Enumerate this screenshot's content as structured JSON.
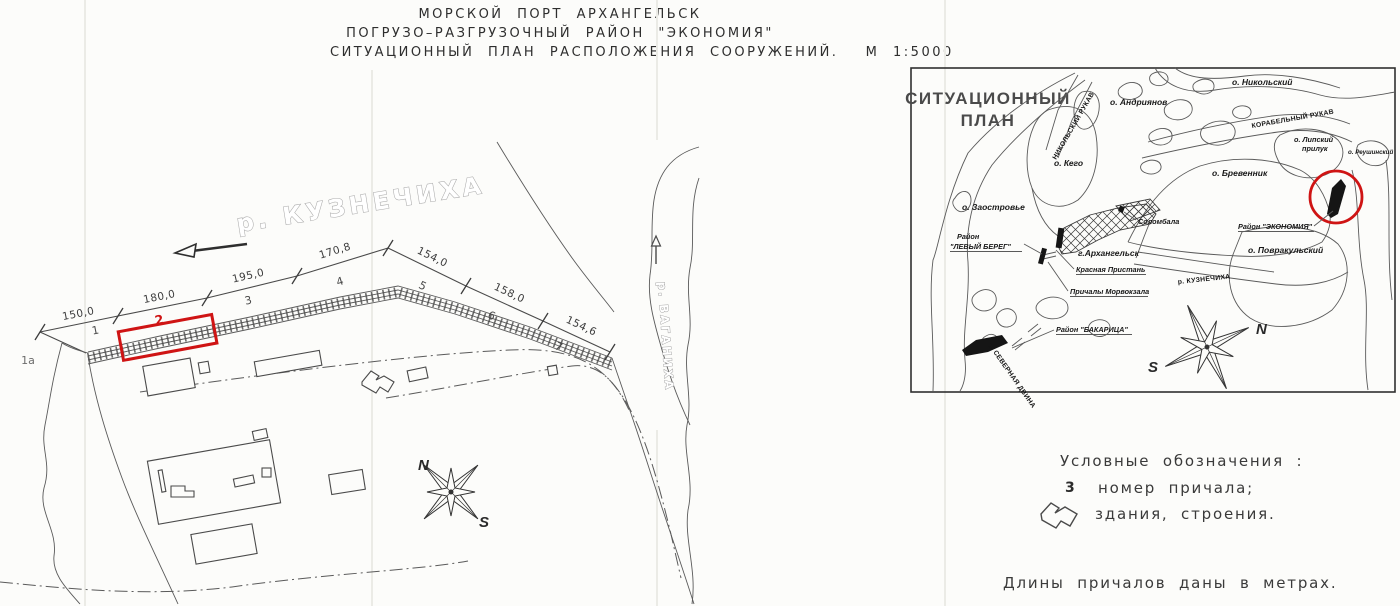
{
  "title": {
    "line1": "МОРСКОЙ ПОРТ АРХАНГЕЛЬСК",
    "line2": "ПОГРУЗО–РАЗГРУЗОЧНЫЙ РАЙОН \"ЭКОНОМИЯ\"",
    "line3": "СИТУАЦИОННЫЙ ПЛАН РАСПОЛОЖЕНИЯ СООРУЖЕНИЙ.  М 1:5000"
  },
  "main_plan": {
    "river_label": "р. КУЗНЕЧИХА",
    "side_river_label": "р. ВАГАНИХА",
    "berth_1a": "1а",
    "berths": [
      {
        "number": "1",
        "length": "150,0"
      },
      {
        "number": "2",
        "length": "180,0"
      },
      {
        "number": "3",
        "length": "195,0"
      },
      {
        "number": "4",
        "length": "170,8"
      },
      {
        "number": "5",
        "length": "154,0"
      },
      {
        "number": "6",
        "length": "158,0"
      },
      {
        "number": "7",
        "length": "154,6"
      }
    ],
    "highlighted_berth": "2",
    "compass": {
      "north": "N",
      "south": "S"
    }
  },
  "inset_map": {
    "title_line1": "СИТУАЦИОННЫЙ",
    "title_line2": "ПЛАН",
    "islands": {
      "nikolsky": "о. Никольский",
      "andriyanov": "о. Андриянов",
      "kego": "о. Кего",
      "brevennik": "о. Бревенник",
      "lipsky_line1": "о. Липский",
      "lipsky_line2": "прилук",
      "reushinsky": "о. Реушинский",
      "zaostrovye": "о. Заостровье",
      "povrakulsky": "о. Повракульский"
    },
    "waterways": {
      "nikolsky_rukav": "НИКОЛЬСКИЙ РУКАВ",
      "korabelny_rukav": "КОРАБЕЛЬНЫЙ РУКАВ",
      "kuznechikha": "р. КУЗНЕЧИХА",
      "severnaya_dvina": "р. СЕВЕРНАЯ ДВИНА"
    },
    "places": {
      "levy_bereg_line1": "Район",
      "levy_bereg_line2": "\"ЛЕВЫЙ БЕРЕГ\"",
      "arkhangelsk": "г.Архангельск",
      "solombala": "Соломбала",
      "krasnaya_pristan": "Красная Пристань",
      "prichaly_morvokzala": "Причалы Морвокзала",
      "ekonomiya": "Район \"ЭКОНОМИЯ\"",
      "bakaritsa": "Район \"БАКАРИЦА\""
    },
    "compass": {
      "north": "N",
      "south": "S"
    }
  },
  "legend": {
    "title": "Условные обозначения :",
    "item1_symbol": "3",
    "item1_text": "номер причала;",
    "item2_text": "здания, строения."
  },
  "footnote": "Длины причалов даны в метрах.",
  "colors": {
    "highlight_red": "#cf1414",
    "ink": "#3c3c3c"
  }
}
